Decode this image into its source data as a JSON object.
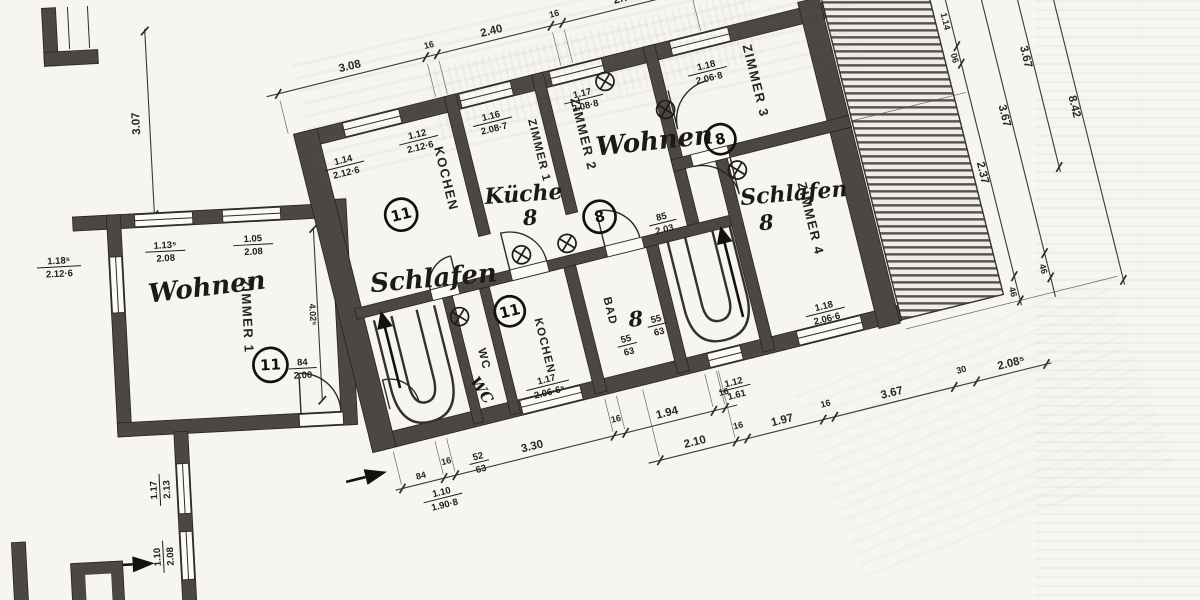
{
  "plan": {
    "rooms": {
      "zimmer1": {
        "hand": "Wohnen",
        "print": "ZIMMER 1",
        "unit": "11"
      },
      "kochen_upper": {
        "hand": "Schlafen",
        "print": "KOCHEN",
        "unit": "11"
      },
      "kueche": {
        "hand": "Küche",
        "print": "ZIMMER 1",
        "note": "8"
      },
      "zimmer2": {
        "hand": "Wohnen",
        "print": "ZIMMER 2",
        "unit": "8"
      },
      "zimmer3": {
        "print": "ZIMMER 3",
        "unit": "8"
      },
      "zimmer4": {
        "hand": "Schlafen",
        "print": "ZIMMER 4",
        "note": "8"
      },
      "wc": {
        "print": "WC",
        "hand": "WC"
      },
      "kochen_lower": {
        "print": "KOCHEN",
        "unit": "11"
      },
      "bad": {
        "print": "BAD",
        "note": "8"
      }
    },
    "chains": {
      "top": [
        "3.08",
        "16",
        "2.40",
        "16",
        "2.70"
      ],
      "left": "3.07",
      "bottom1": [
        "84",
        "16",
        "3.30",
        "16",
        "1.94",
        "16"
      ],
      "bottom2": [
        "2.10",
        "16",
        "1.97",
        "16",
        "3.67",
        "30",
        "2.08⁵"
      ],
      "right1": [
        "16",
        "1.14",
        "06",
        "2.37",
        "46"
      ],
      "right2": [
        "16",
        "3.67",
        "46"
      ],
      "right3": "3.67",
      "right4": "8.42"
    },
    "fr": {
      "wing_w1": {
        "a": "1.13⁵",
        "b": "2.08"
      },
      "wing_w2": {
        "a": "1.05",
        "b": "2.08"
      },
      "wing_left": {
        "a": "1.18⁵",
        "b": "2.12·6"
      },
      "wing_door": {
        "a": "84",
        "b": "2.00"
      },
      "wing_h": "4.02⁵",
      "ext_w1": {
        "a": "1.17",
        "b": "2.13"
      },
      "ext_w2": {
        "a": "1.10",
        "b": "2.08"
      },
      "schl_w1": {
        "a": "1.14",
        "b": "2.12·6"
      },
      "schl_w2": {
        "a": "1.12",
        "b": "2.12·6"
      },
      "kue_w": {
        "a": "1.16",
        "b": "2.08·7"
      },
      "z2_w": {
        "a": "1.17",
        "b": "2.08·8"
      },
      "z3_w": {
        "a": "1.18",
        "b": "2.06·8"
      },
      "z4_w": {
        "a": "1.18",
        "b": "2.06·6"
      },
      "koch_w": {
        "a": "1.17",
        "b": "2.06·6⁵"
      },
      "bad1": {
        "a": "55",
        "b": "63"
      },
      "bad2": {
        "a": "55",
        "b": "63"
      },
      "stair_door": {
        "a": "85",
        "b": "2.03"
      },
      "low_win": {
        "a": "1.12",
        "b": "1.61"
      },
      "entry": {
        "a": "1.10",
        "b": "1.90·8"
      },
      "small52": {
        "a": "52",
        "b": "63"
      }
    }
  }
}
